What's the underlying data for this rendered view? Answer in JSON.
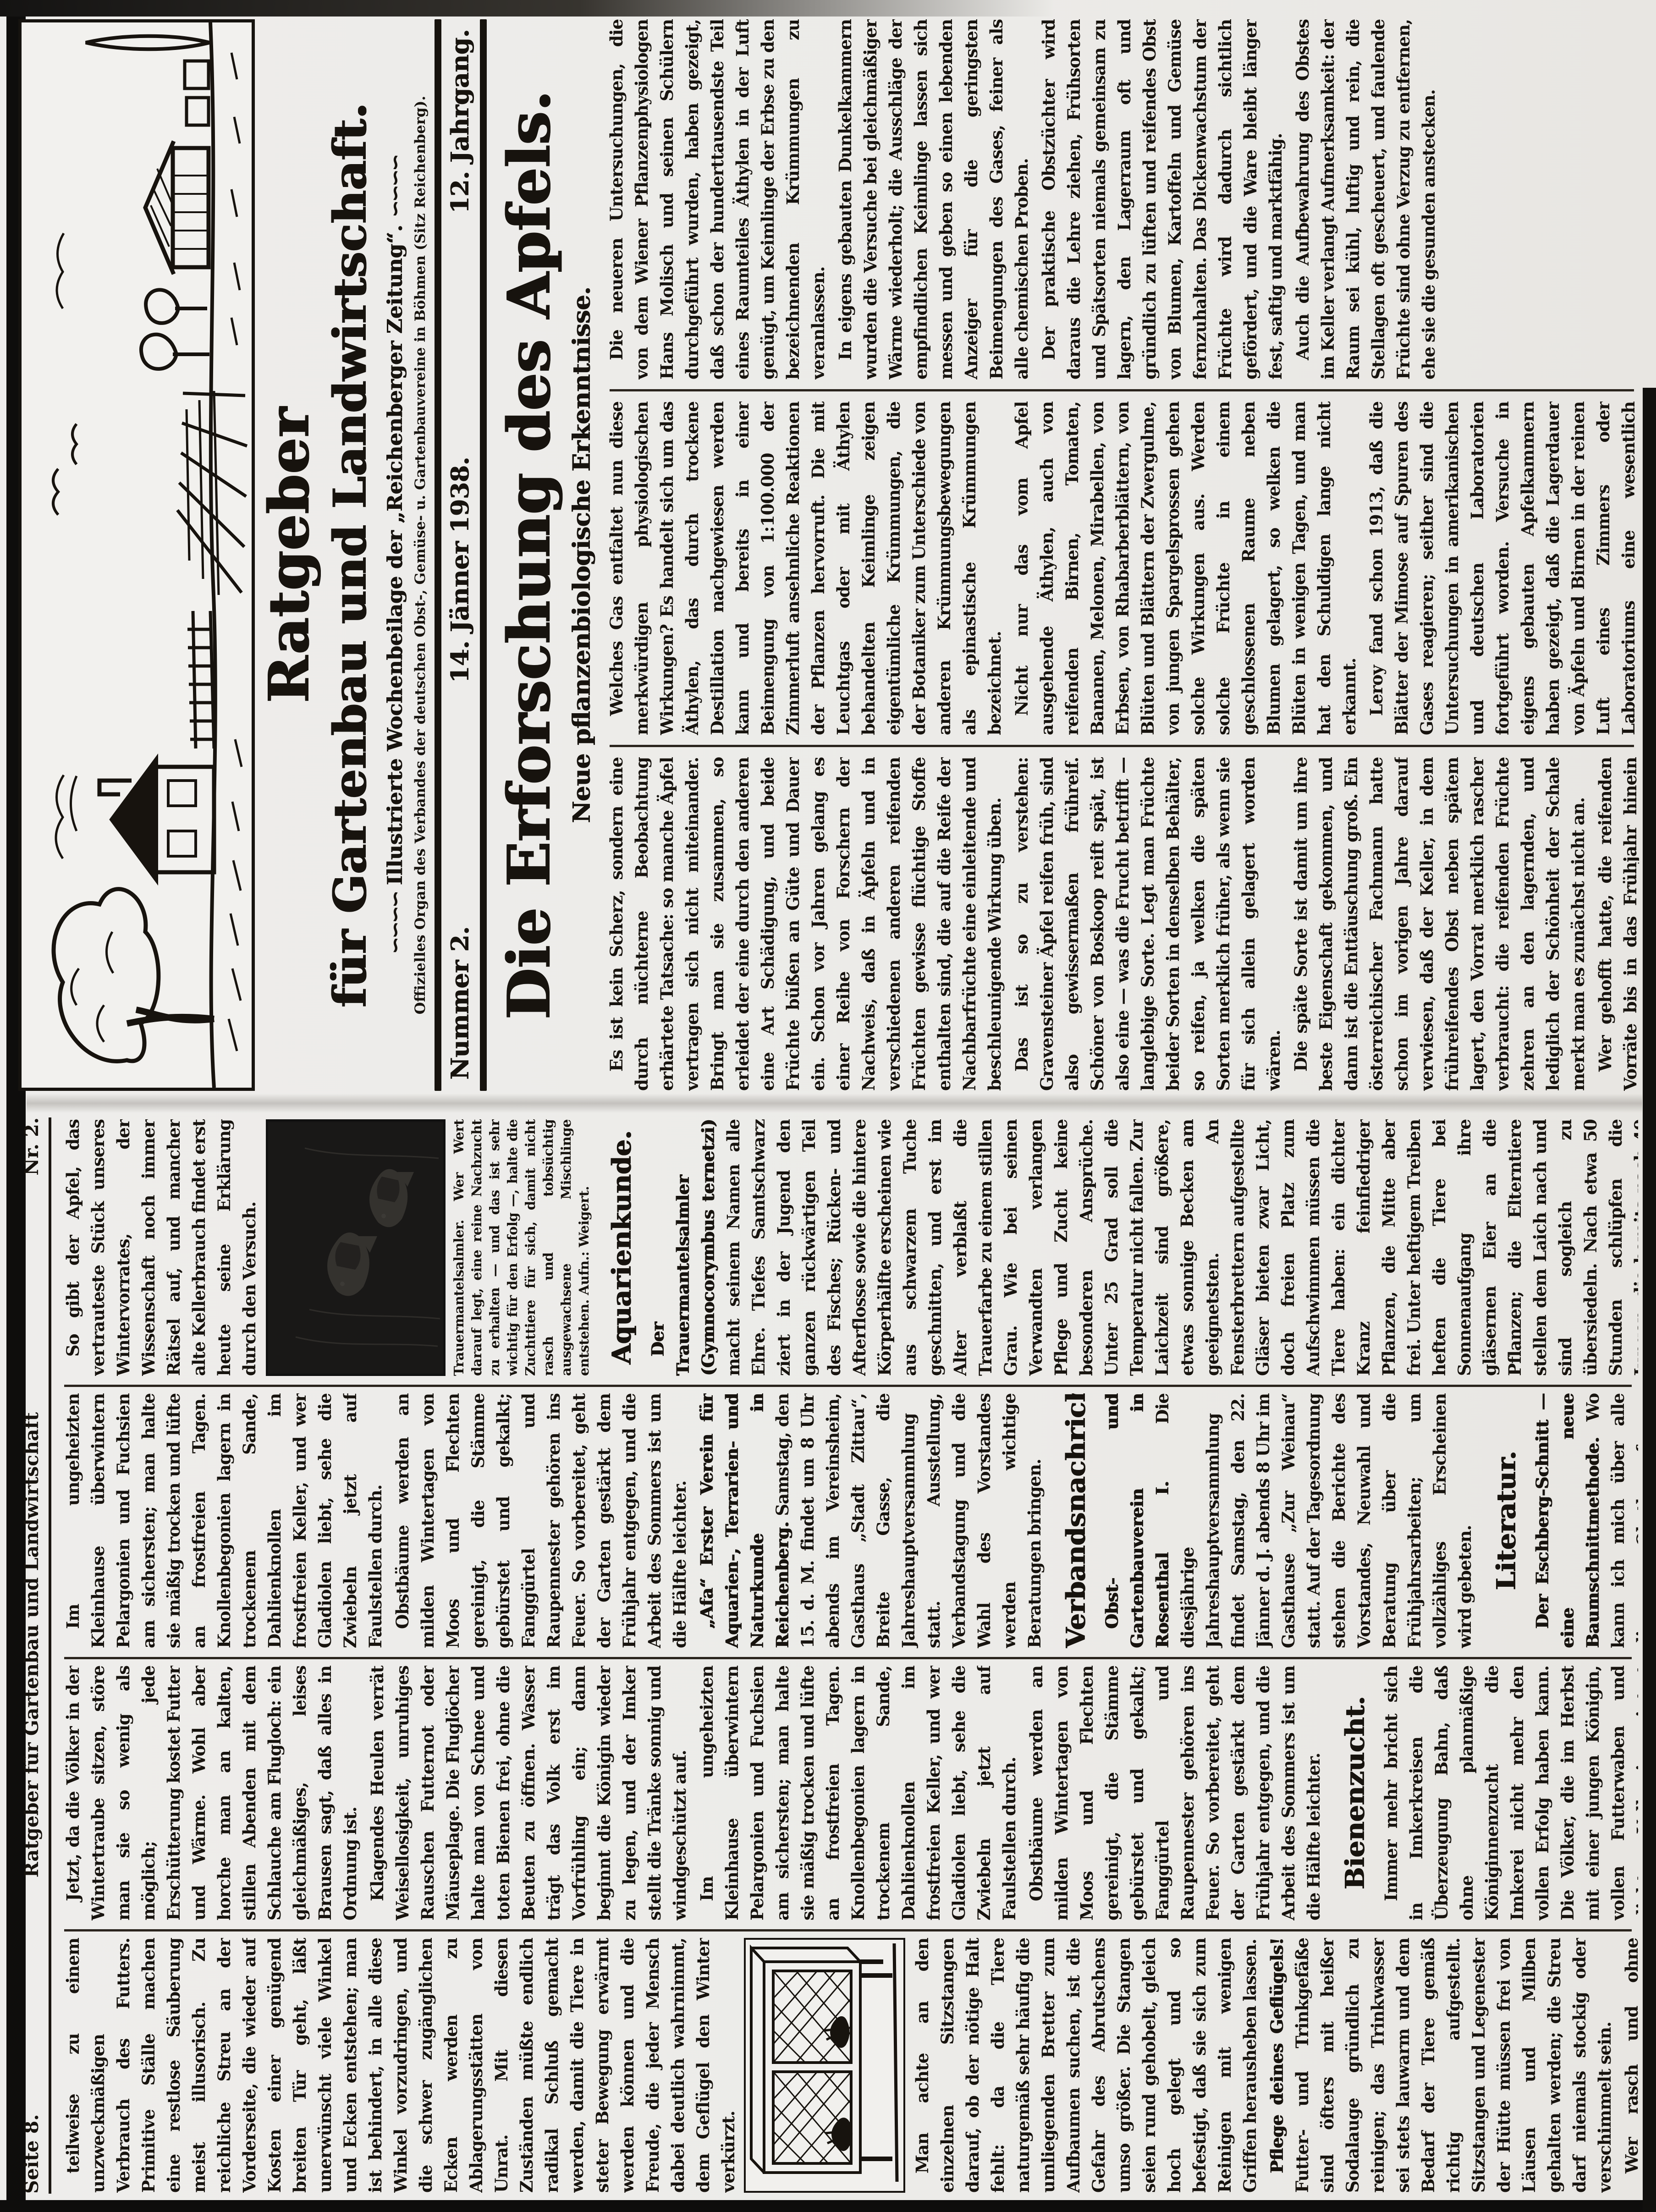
{
  "masthead": {
    "title1": "Ratgeber",
    "title2": "für Gartenbau und Landwirtschaft.",
    "ornament": "∽∽∽∽",
    "subtitle": "Illustrierte Wochenbeilage der „Reichenberger Zeitung“.",
    "organ": "Offizielles Organ des Verbandes der deutschen Obst-, Gemüse- u. Gartenbauvereine in Böhmen (Sitz Reichenberg).",
    "number": "Nummer 2.",
    "date": "14. Jänner 1938.",
    "volume": "12. Jahrgang."
  },
  "page8_head": {
    "left": "Seite 8.",
    "center": "Ratgeber für Gartenbau und Landwirtschaft",
    "right": "Nr. 2."
  },
  "lead": {
    "headline": "Die Erforschung des Apfels.",
    "subhead": "Neue pflanzenbiologische Erkenntnisse."
  },
  "ink_color": "#17130e",
  "paper_color": "#ecebe8",
  "texts": {
    "apple_a": "Es ist kein Scherz, sondern eine durch nüchterne Beobachtung erhärtete Tatsache: so manche Äpfel vertragen sich nicht miteinander. Bringt man sie zusammen, so erleidet der eine durch den anderen eine Art Schädigung, und beide Früchte büßen an Güte und Dauer ein. Schon vor Jahren gelang es einer Reihe von Forschern der Nachweis, daß in Äpfeln und in verschiedenen anderen reifenden Früchten gewisse flüchtige Stoffe enthalten sind, die auf die Reife der Nachbarfrüchte eine einleitende und beschleunigende Wirkung üben.",
    "apple_b": "Das ist so zu verstehen: Gravensteiner Äpfel reifen früh, sind also gewissermaßen frühreif. Schöner von Boskoop reift spät, ist also eine — was die Frucht betrifft — langlebige Sorte. Legt man Früchte beider Sorten in denselben Behälter, so reifen, ja welken die späten Sorten merklich früher, als wenn sie für sich allein gelagert worden wären.",
    "apple_c": "Die späte Sorte ist damit um ihre beste Eigenschaft gekommen, und dann ist die Enttäuschung groß. Ein österreichischer Fachmann hatte schon im vorigen Jahre darauf verwiesen, daß der Keller, in dem frühreifendes Obst neben spätem lagert, den Vorrat merklich rascher verbraucht: die reifenden Früchte zehren an den lagernden, und lediglich der Schönheit der Schale merkt man es zunächst nicht an.",
    "apple_cc": "Wer gehofft hatte, die reifenden Vorräte bis in das Frühjahr hinein verbrauchen zu können, erlebt dann die Enttäuschung: die späte Sorte ist hin, ehe ihre Zeit gekommen war.",
    "apple_d": "Welches Gas entfaltet nun diese merkwürdigen physiologischen Wirkungen? Es handelt sich um das Äthylen, das durch trockene Destillation nachgewiesen werden kann und bereits in einer Beimengung von 1:100.000 der Zimmerluft ansehnliche Reaktionen der Pflanzen hervorruft. Die mit Leuchtgas oder mit Äthylen behandelten Keimlinge zeigen eigentümliche Krümmungen, die der Botaniker zum Unterschiede von anderen Krümmungsbewegungen als epinastische Krümmungen bezeichnet.",
    "apple_e": "Nicht nur das vom Apfel ausgehende Äthylen, auch von reifenden Birnen, Tomaten, Bananen, Melonen, Mirabellen, von Erbsen, von Rhabarberblättern, von Blüten und Blättern der Zwergulme, von jungen Spargelsprossen gehen solche Wirkungen aus. Werden solche Früchte in einem geschlossenen Raume neben Blumen gelagert, so welken die Blüten in wenigen Tagen, und man hat den Schuldigen lange nicht erkannt.",
    "apple_f": "Leroy fand schon 1913, daß die Blätter der Mimose auf Spuren des Gases reagieren; seither sind die Untersuchungen in amerikanischen und deutschen Laboratorien fortgeführt worden. Versuche in eigens gebauten Apfelkammern haben gezeigt, daß die Lagerdauer von Äpfeln und Birnen in der reinen Luft eines Zimmers oder Laboratoriums eine wesentlich andere ist als in der mit Äthylen geschwängerten Kellerluft.",
    "apple_g": "Der praktische Obstzüchter wird daraus die Lehre ziehen, Frühsorten und Spätsorten niemals gemeinsam zu lagern, den Lagerraum oft und gründlich zu lüften und reifendes Obst von Blumen, Kartoffeln und Gemüse fernzuhalten. Das Dickenwachstum der Früchte wird dadurch sichtlich gefördert, und die Ware bleibt länger fest, saftig und marktfähig.",
    "lab_a": "Die neueren Untersuchungen, die von dem Wiener Pflanzenphysiologen Hans Molisch und seinen Schülern durchgeführt wurden, haben gezeigt, daß schon der hunderttausendste Teil eines Raumteiles Äthylen in der Luft genügt, um Keimlinge der Erbse zu den bezeichnenden Krümmungen zu veranlassen.",
    "lab_b": "In eigens gebauten Dunkelkammern wurden die Versuche bei gleichmäßiger Wärme wiederholt; die Ausschläge der empfindlichen Keimlinge lassen sich messen und geben so einen lebenden Anzeiger für die geringsten Beimengungen des Gases, feiner als alle chemischen Proben.",
    "cont_a": "Auch die Aufbewahrung des Obstes im Keller verlangt Aufmerksamkeit: der Raum sei kühl, luftig und rein, die Stellagen oft gescheuert, und faulende Früchte sind ohne Verzug zu entfernen, ehe sie die gesunden anstecken.",
    "cont_d": "So gibt der Apfel, das vertrauteste Stück unseres Wintervorrates, der Wissenschaft noch immer Rätsel auf, und mancher alte Kellerbrauch findet erst heute seine Erklärung durch den Versuch.",
    "gart_a": "Im ungeheizten Kleinhause überwintern Pelargonien und Fuchsien am sichersten; man halte sie mäßig trocken und lüfte an frostfreien Tagen. Knollenbegonien lagern in trockenem Sande, Dahlienknollen im frostfreien Keller, und wer Gladiolen liebt, sehe die Zwiebeln jetzt auf Faulstellen durch.",
    "gart_b": "Obstbäume werden an milden Wintertagen von Moos und Flechten gereinigt, die Stämme gebürstet und gekalkt; Fanggürtel und Raupennester gehören ins Feuer. So vorbereitet, geht der Garten gestärkt dem Frühjahr entgegen, und die Arbeit des Sommers ist um die Hälfte leichter.",
    "bee_0a": "Jetzt, da die Völker in der Wintertraube sitzen, störe man sie so wenig als möglich; jede Erschütterung kostet Futter und Wärme. Wohl aber horche man an kalten, stillen Abenden mit dem Schlauche am Flugloch: ein gleichmäßiges, leises Brausen sagt, daß alles in Ordnung ist.",
    "bee_0b": "Klagendes Heulen verrät Weisellosigkeit, unruhiges Rauschen Futternot oder Mäuseplage. Die Fluglöcher halte man von Schnee und toten Bienen frei, ohne die Beuten zu öffnen. Wasser trägt das Volk erst im Vorfrühling ein; dann beginnt die Königin wieder zu legen, und der Imker stellt die Tränke sonnig und windgeschützt auf.",
    "bee_1": "Immer mehr bricht sich in Imkerkreisen die Überzeugung Bahn, daß ohne planmäßige Königinnenzucht die Imkerei nicht mehr den vollen Erfolg haben kann. Die Völker, die im Herbst mit einer jungen Königin, vollen Futterwaben und dichtem Volk eingewintert wurden, kommen am besten durch den Winter. Dazu kommen dann die Rähmchen, die von anderen sehr leicht angenommen werden, nachdem man sie leicht überbraust hat. An warmen Tagen, in denen sie fliegen, achte man auf eine Nachschwarmkönigin, die sich im Volke zeigen kann.",
    "aqua_lead": "Der Trauermantelsalmler (Gymnocorymbus ternetzi)",
    "aqua_1": "macht seinem Namen alle Ehre. Tiefes Samtschwarz ziert in der Jugend den ganzen rückwärtigen Teil des Fisches; Rücken- und Afterflosse sowie die hintere Körperhälfte erscheinen wie aus schwarzem Tuche geschnitten, und erst im Alter verblaßt die Trauerfarbe zu einem stillen Grau. Wie bei seinen Verwandten verlangen Pflege und Zucht keine besonderen Ansprüche. Unter 25 Grad soll die Temperatur nicht fallen. Zur Laichzeit sind größere, etwas sonnige Becken am geeignetsten. An Fensterbrettern aufgestellte Gläser bieten zwar Licht, doch freien Platz zum Aufschwimmen müssen die Tiere haben: ein dichter Kranz feinfiedriger Pflanzen, die Mitte aber frei. Unter heftigem Treiben heften die Tiere bei Sonnenaufgang ihre gläsernen Eier an die Pflanzen; die Elterntiere stellen dem Laich nach und sind sogleich zu übersiedeln. Nach etwa 50 Stunden schlüpfen die Jungen, die bereits nach 40 weiteren Stunden frei schwimmen. Die Heimat des schwarzen Salmlers sind die Teiche und Flüsse des Matogrosso in Brasilien und Paraguay.",
    "caption_fish": "Trauermantelsalmler. Wer Wert darauf legt, eine reine Nachzucht zu erhalten — und das ist sehr wichtig für den Erfolg —, halte die Zuchttiere für sich, damit nicht rasch und tobsüchtig ausgewachsene Mischlinge entstehen. Aufn.: Weigert.",
    "afa_lead": "„Afa“ Erster Verein für Aquarien-, Terrarien- und Naturkunde in Reichenberg.",
    "afa_1": "Samstag, den 15. d. M. findet um 8 Uhr abends im Vereinsheim, Gasthaus „Stadt Zittau“, Breite Gasse, die Jahreshauptversammlung statt. Ausstellung, Verbandstagung und die Wahl des Vorstandes werden wichtige Beratungen bringen.",
    "obst_lead": "Obst- und Gartenbauverein in Rosenthal I.",
    "obst_1": "Die diesjährige Jahreshauptversammlung findet Samstag, den 22. Jänner d. J. abends 8 Uhr im Gasthause „Zur Weinau“ statt. Auf der Tagesordnung stehen die Berichte des Vorstandes, Neuwahl und Beratung über die Frühjahrsarbeiten; um vollzähliges Erscheinen wird gebeten.",
    "esch_lead": "Der Eschberg-Schnitt — eine neue Baumschnittmethode.",
    "esch_1": "Wo kann ich mich über alle diese Obstbaumfragen unterrichten? Die vielgelesene Wiener Fachschrift „Mein Sonntagsblatt“ bringt in Folge 41 eine leichtfaßliche Darstellung des neuen Schnittes mit zahlreichen Bildern. Probefolgen stellt die Verwaltung von „Mein Sonntagsblatt“ gegen Voreinsendung von 10 Kč für das Vierteljahr gern zur Verfügung.",
    "stall_1": "teilweise zu einem unzweckmäßigen Verbrauch des Futters. Primitive Ställe machen eine restlose Säuberung meist illusorisch. Zu reichliche Streu an der Vorderseite, die wieder auf Kosten einer genügend breiten Tür geht, läßt unerwünscht viele Winkel und Ecken entstehen; man ist behindert, in alle diese Winkel vorzudringen, und die schwer zugänglichen Ecken werden zu Ablagerungsstätten von Unrat. Mit diesen Zuständen müßte endlich radikal Schluß gemacht werden, damit die Tiere in steter Bewegung erwärmt werden können und die Freude, die jeder Mensch dabei deutlich wahrnimmt, dem Geflügel den Winter verkürzt.",
    "stall_2": "Man achte an den einzelnen Sitzstangen darauf, ob der nötige Halt fehlt: da die Tiere naturgemäß sehr häufig die umliegenden Bretter zum Aufbaumen suchen, ist die Gefahr des Abrutschens umso größer. Die Stangen seien rund gehobelt, gleich hoch gelegt und so befestigt, daß sie sich zum Reinigen mit wenigen Griffen herausheben lassen.",
    "gefl_lead": "Pflege deines Geflügels!",
    "gefl_1": "Futter- und Trinkgefäße sind öfters mit heißer Sodalauge gründlich zu reinigen; das Trinkwasser sei stets lauwarm und dem Bedarf der Tiere gemäß richtig aufgestellt. Sitzstangen und Legenester der Hütte müssen frei von Läusen und Milben gehalten werden; die Streu darf niemals stockig oder verschimmelt sein.",
    "gefl_2": "Wer rasch und ohne Verluste aufziehen will, gebe mit dem Futter nicht zu sparsam und halte die Jungtiere von den alten getrennt; ein sonniger, trockener Auslauf ist die halbe Aufzucht.",
    "h_aqua": "Aquarienkunde.",
    "h_verband": "Verbandsnachrichten.",
    "h_lit": "Literatur.",
    "h_bienen": "Bienenzucht.",
    "notice": "Nachdruck sämtlicher Beiträge verboten."
  },
  "columns": {
    "p1_colC": [
      {
        "t": "p",
        "k": "apple_a"
      },
      {
        "t": "p",
        "k": "apple_b"
      },
      {
        "t": "p",
        "k": "apple_c"
      },
      {
        "t": "p",
        "k": "apple_cc"
      }
    ],
    "p1_colB": [
      {
        "t": "p",
        "k": "apple_d"
      },
      {
        "t": "p",
        "k": "apple_e"
      },
      {
        "t": "p",
        "k": "apple_f"
      }
    ],
    "p1_colA": [
      {
        "t": "p",
        "k": "lab_a"
      },
      {
        "t": "p",
        "k": "lab_b"
      },
      {
        "t": "p",
        "k": "apple_g"
      },
      {
        "t": "p",
        "k": "cont_a"
      }
    ],
    "p8_col4": [
      {
        "t": "p",
        "k": "cont_d"
      },
      {
        "t": "img",
        "id": "fish-photo"
      },
      {
        "t": "cap",
        "k": "caption_fish"
      },
      {
        "t": "h",
        "k": "h_aqua"
      },
      {
        "t": "pb",
        "lead": "aqua_lead",
        "k": "aqua_1"
      }
    ],
    "p8_col3": [
      {
        "t": "p",
        "k": "gart_a"
      },
      {
        "t": "p",
        "k": "gart_b"
      },
      {
        "t": "pb",
        "lead": "afa_lead",
        "k": "afa_1"
      },
      {
        "t": "h",
        "k": "h_verband"
      },
      {
        "t": "pb",
        "lead": "obst_lead",
        "k": "obst_1"
      },
      {
        "t": "h",
        "k": "h_lit"
      },
      {
        "t": "pb",
        "lead": "esch_lead",
        "k": "esch_1"
      },
      {
        "t": "n",
        "k": "notice"
      }
    ],
    "p8_col2": [
      {
        "t": "p",
        "k": "bee_0a"
      },
      {
        "t": "p",
        "k": "bee_0b"
      },
      {
        "t": "p",
        "k": "gart_a"
      },
      {
        "t": "p",
        "k": "gart_b"
      },
      {
        "t": "h",
        "k": "h_bienen"
      },
      {
        "t": "p",
        "k": "bee_1"
      }
    ],
    "p8_col1": [
      {
        "t": "p",
        "k": "stall_1"
      },
      {
        "t": "img",
        "id": "hutch-pic"
      },
      {
        "t": "p",
        "k": "stall_2"
      },
      {
        "t": "pb",
        "lead": "gefl_lead",
        "k": "gefl_1"
      },
      {
        "t": "p",
        "k": "gefl_2"
      }
    ]
  }
}
